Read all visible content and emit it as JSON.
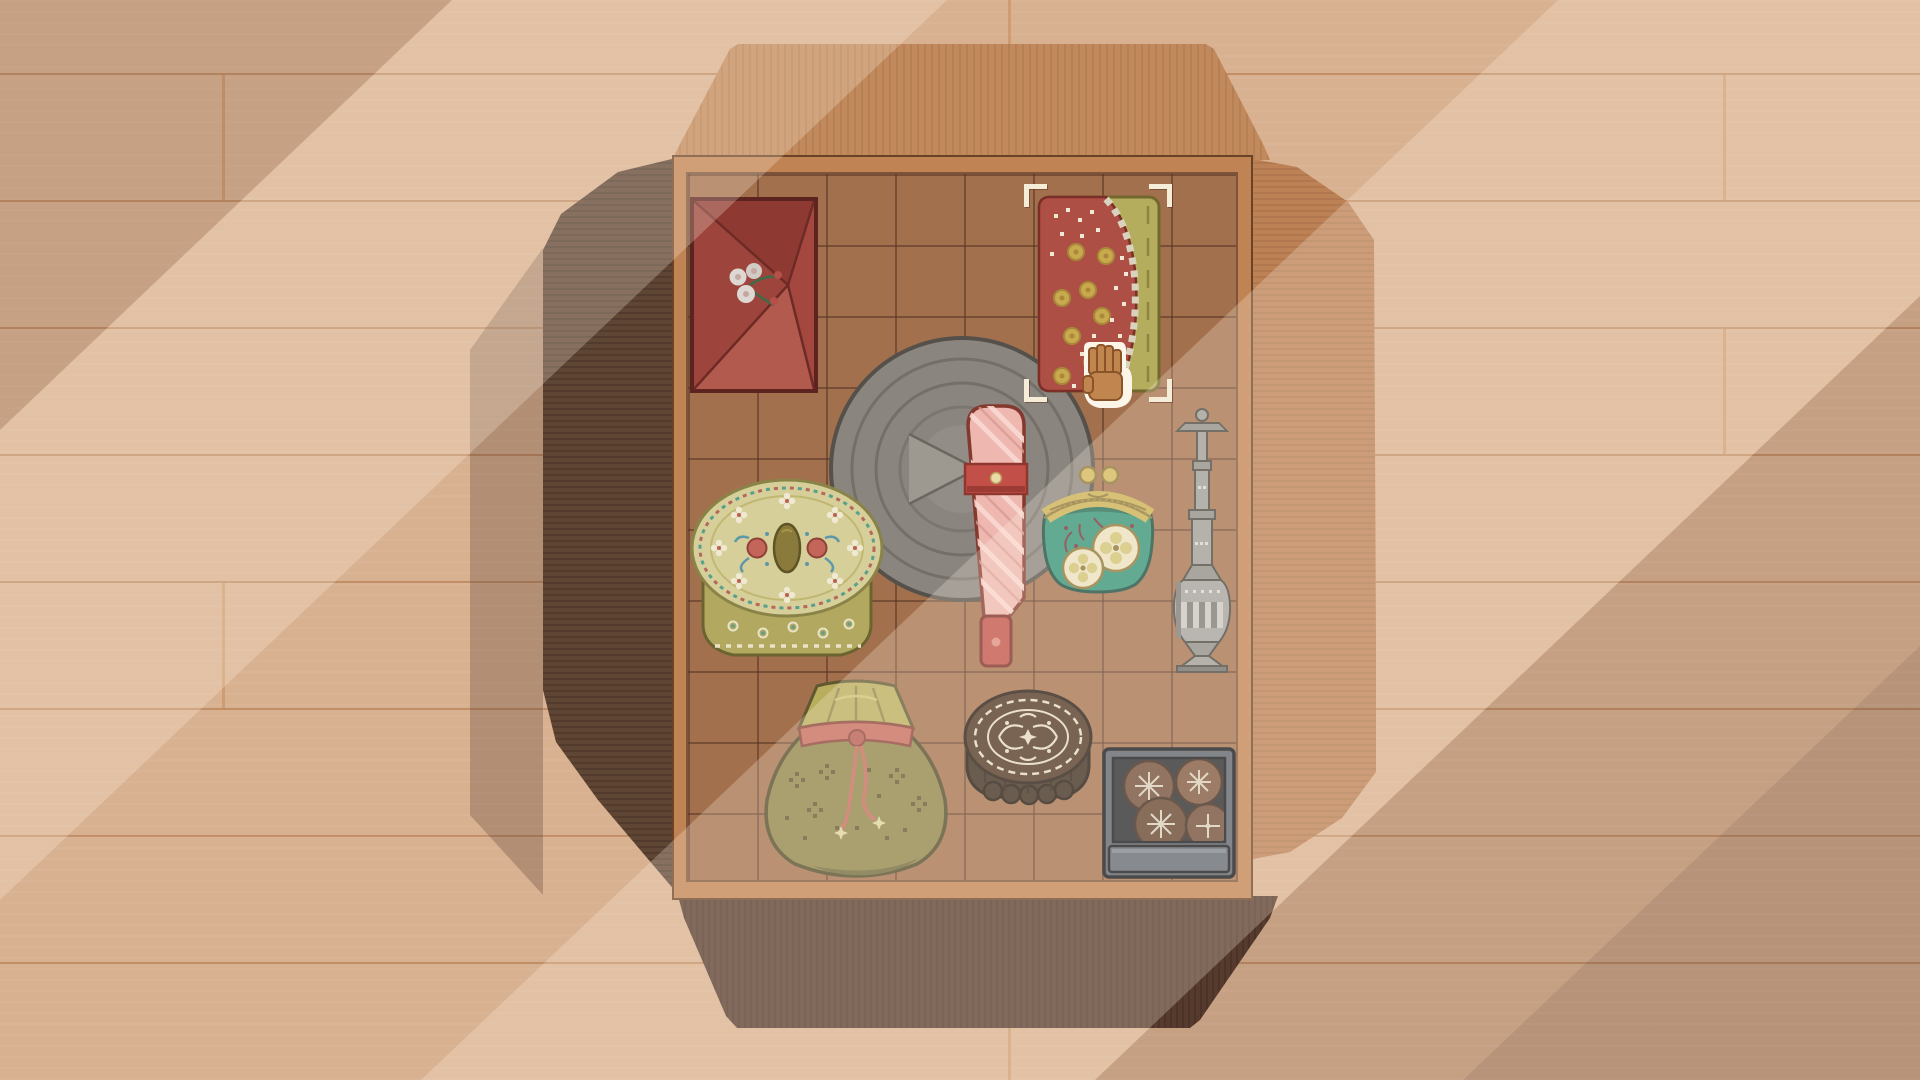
{
  "scene": {
    "description": "Pixel-art organizing game scene: an open cardboard keepsake box seen from above on a wooden plank floor, diagonal light beams crossing the room",
    "background": "tan wooden planks",
    "grid": {
      "columns": 8,
      "rows": 10
    }
  },
  "items": {
    "envelope": {
      "name": "red envelope with plum-blossom motif",
      "bounds": {
        "x": 690,
        "y": 197,
        "w": 128,
        "h": 196
      }
    },
    "plate": {
      "name": "grey stone plate with concentric rings",
      "bounds": {
        "x": 827,
        "y": 334,
        "w": 270,
        "h": 270
      }
    },
    "tin": {
      "name": "round floral cross-stitch tin box",
      "bounds": {
        "x": 689,
        "y": 476,
        "w": 196,
        "h": 192
      }
    },
    "parcel": {
      "name": "pink cloth-wrapped handle parcel",
      "bounds": {
        "x": 960,
        "y": 402,
        "w": 72,
        "h": 268
      }
    },
    "purse": {
      "name": "teal clasp coin purse with fruit medallions",
      "bounds": {
        "x": 1036,
        "y": 460,
        "w": 124,
        "h": 138
      }
    },
    "vase": {
      "name": "tall silver metal vase",
      "bounds": {
        "x": 1169,
        "y": 404,
        "w": 66,
        "h": 272
      }
    },
    "fan": {
      "name": "red and olive folding fan with coin pattern",
      "bounds": {
        "x": 1036,
        "y": 194,
        "w": 126,
        "h": 200
      }
    },
    "sack": {
      "name": "olive drawstring pouch with red cord",
      "bounds": {
        "x": 755,
        "y": 676,
        "w": 202,
        "h": 204
      }
    },
    "mooncake": {
      "name": "dark mooncake with ornate pressed pattern",
      "bounds": {
        "x": 961,
        "y": 679,
        "w": 134,
        "h": 136
      }
    },
    "cookiebox": {
      "name": "slate tin of decorated cookies",
      "bounds": {
        "x": 1101,
        "y": 746,
        "w": 136,
        "h": 134
      }
    }
  },
  "selection": {
    "target": "fan",
    "style": "corner-brackets",
    "bounds": {
      "x": 1024,
      "y": 184,
      "w": 148,
      "h": 218
    }
  },
  "cursor": {
    "type": "open-hand",
    "bounds": {
      "x": 1078,
      "y": 334,
      "w": 56,
      "h": 76
    }
  },
  "colors": {
    "bg": "#d8b190",
    "plank_line": "#c18e66",
    "plank_joint": "#cf9c72",
    "flap_top": "#c28a5c",
    "flap_right": "#bd8156",
    "flap_left": "#5f4534",
    "flap_bottom": "#573d2e",
    "frame": "#c08353",
    "tile": "#a3704e",
    "grid_line": "#7e5339",
    "selection": "#f6edd8",
    "cursor_hand": "#c1854f",
    "beam_light": "#fff3e2"
  }
}
